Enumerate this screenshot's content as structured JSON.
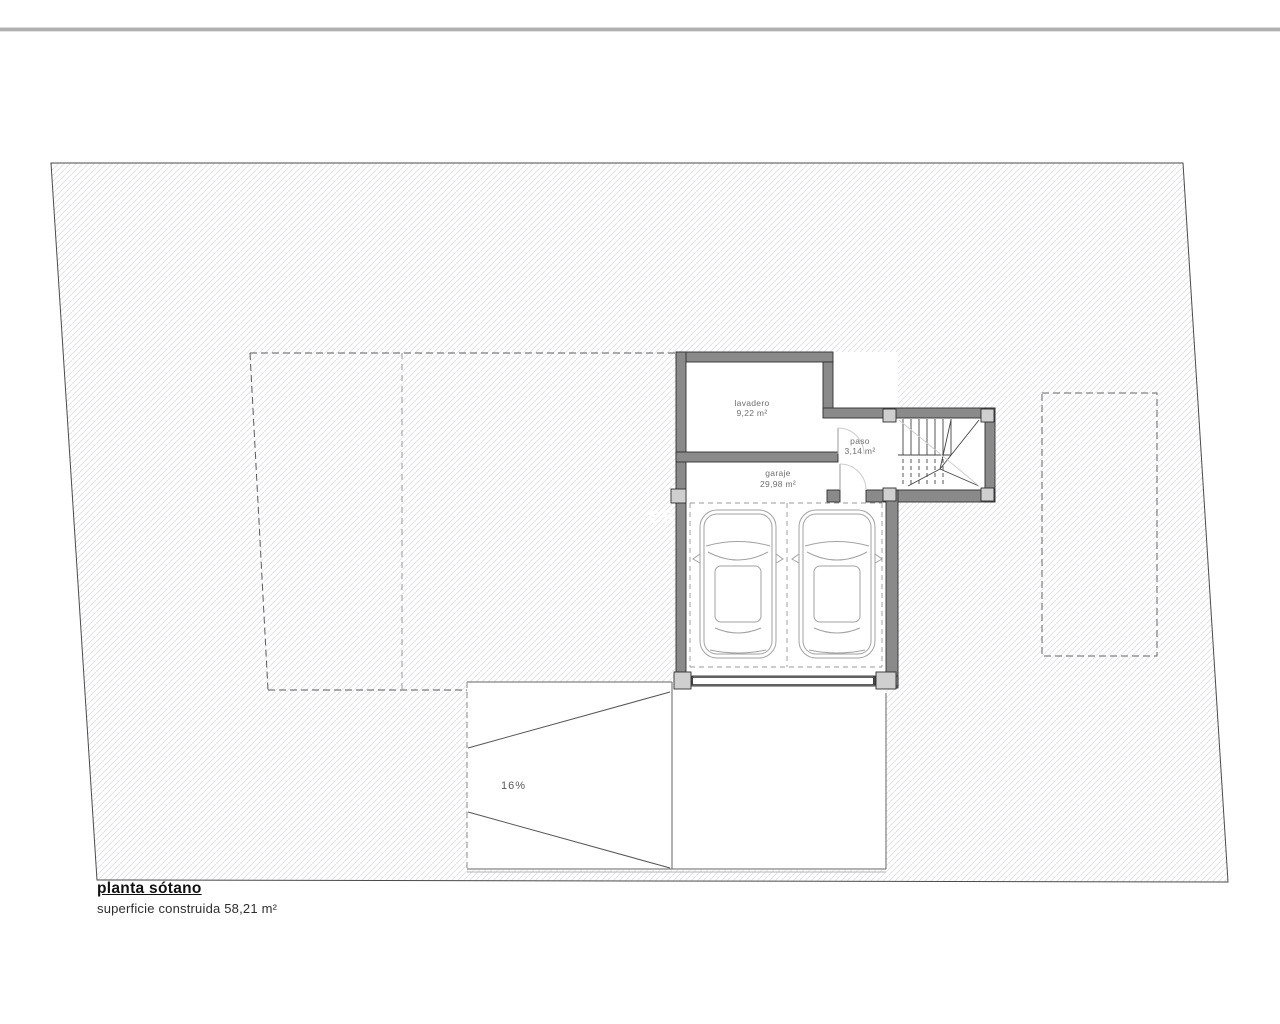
{
  "plan": {
    "rooms": [
      {
        "name": "lavadero",
        "area": "9,22 m²"
      },
      {
        "name": "paso",
        "area": "3,14 m²"
      },
      {
        "name": "garaje",
        "area": "29,98 m²"
      }
    ],
    "ramp": {
      "slope_label": "16%"
    },
    "watermark_text": "es"
  },
  "title_block": {
    "title": "planta sótano",
    "subtitle": "superficie construida 58,21 m²"
  },
  "colors": {
    "wall": "#8a8a8a",
    "pillar": "#cfcfcf",
    "hatch_line": "#e5e5e9",
    "boundary": "#4a4a4a",
    "label_text": "#6f6f6f",
    "top_rule": "#b0b0b0"
  }
}
